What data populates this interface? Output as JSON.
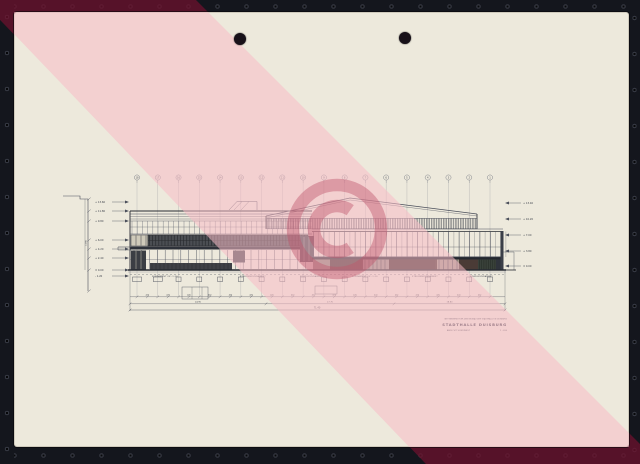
{
  "watermark": {
    "symbol": "©",
    "stripe_color_on_paper": "rgba(247,187,198,0.55)",
    "stripe_color_on_frame": "rgba(112,16,46,0.72)",
    "copyright_color": "rgba(192,84,106,0.44)"
  },
  "palette": {
    "paper": "#EDE9DC",
    "frame": "#14161d",
    "ink": "#4a4e5a",
    "ink_heavy": "#262a32"
  },
  "drawing": {
    "grid_labels": [
      "18",
      "17",
      "16",
      "15",
      "14",
      "13",
      "12",
      "11",
      "10",
      "9",
      "8",
      "7",
      "6",
      "5",
      "4",
      "3",
      "2",
      "1"
    ],
    "left_levels": [
      "+ 13.60",
      "+ 11.80",
      "+ 9.80",
      "+ 6.00",
      "+ 4.20",
      "+ 2.40",
      "± 0.00",
      "- 1.20"
    ],
    "right_levels": [
      "+ 13.40",
      "+ 10.20",
      "+ 7.00",
      "+ 3.80",
      "± 0.00"
    ],
    "vertical_dim": "14.60",
    "footing_labels": [
      "FUNDAMENT OK -1.20",
      "STREIFENFUNDAMENT",
      "EINZELFUNDAMENT",
      "FUNDAMENT OK -1.20",
      "STREIFENFUNDAMENT",
      "EINZELFUNDAMENT"
    ],
    "dim_row1": [
      "420",
      "420",
      "420",
      "420",
      "420",
      "420",
      "420",
      "420",
      "420",
      "420",
      "420",
      "420",
      "420",
      "420",
      "420",
      "420",
      "420"
    ],
    "dim_row2": [
      "24.90",
      "27.70",
      "18.80"
    ],
    "dim_total": "71.40",
    "title_block": {
      "line1": "WETTBEWERB FUER DEN NEUBAU DER STADTHALLE IN DUISBURG",
      "project": "STADTHALLE DUISBURG",
      "view": "ANSICHT SUEDWEST",
      "scale": "1 : 200"
    }
  }
}
